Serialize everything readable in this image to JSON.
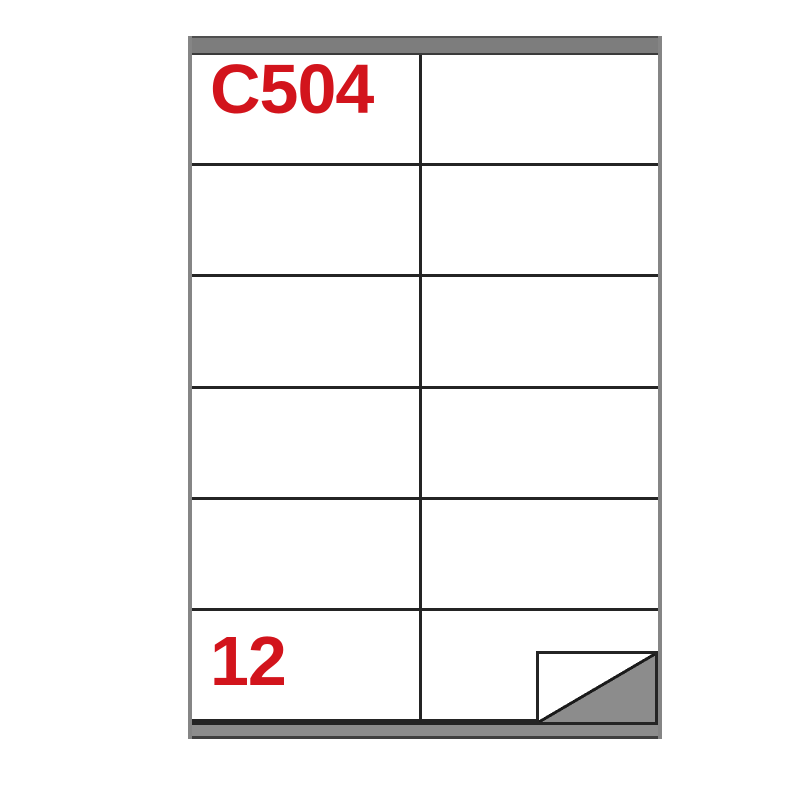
{
  "sheet": {
    "product_code": "C504",
    "labels_per_sheet": "12",
    "rows": 6,
    "columns": 2,
    "icons": {
      "fold": "folded-corner-icon"
    },
    "colors": {
      "accent_red": "#d2141c",
      "strip_gray": "#7d7d7d",
      "edge_gray": "#858585",
      "grid_line": "#242424",
      "fold_gray": "#8c8c8c",
      "paper_white": "#ffffff"
    }
  }
}
